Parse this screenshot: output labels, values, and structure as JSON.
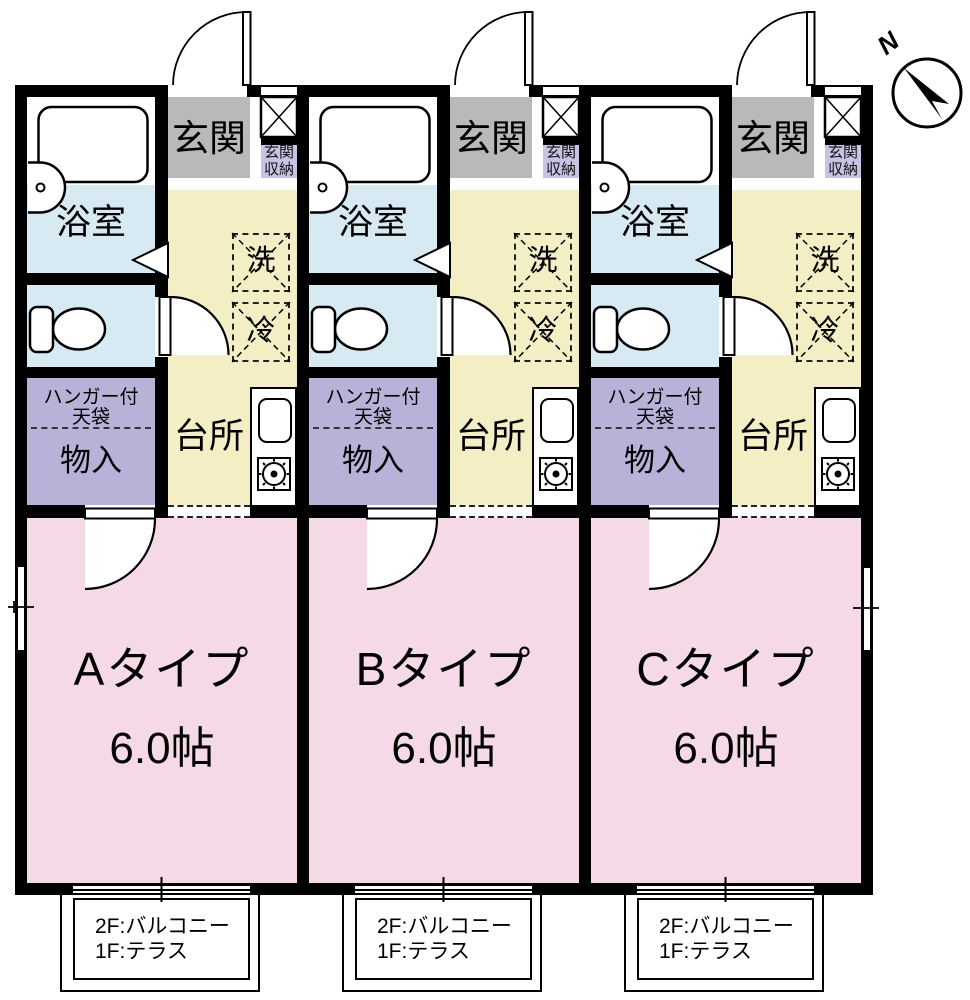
{
  "compass": {
    "label": "N"
  },
  "units": [
    {
      "id": "A",
      "type_label": "Aタイプ",
      "size_label": "6.0帖"
    },
    {
      "id": "B",
      "type_label": "Bタイプ",
      "size_label": "6.0帖"
    },
    {
      "id": "C",
      "type_label": "Cタイプ",
      "size_label": "6.0帖"
    }
  ],
  "room_labels": {
    "entrance": "玄関",
    "entrance_storage": "玄関\n収納",
    "bathroom": "浴室",
    "washer": "洗",
    "refrigerator": "冷",
    "kitchen": "台所",
    "closet_upper": "ハンガー付\n天袋",
    "closet": "物入"
  },
  "balcony_note": "2F:バルコニー\n1F:テラス",
  "colors": {
    "wall": "#000000",
    "entrance_floor": "#b9b9b9",
    "hall_kitchen_floor": "#f4eec5",
    "bath_toilet_floor": "#d7eaf4",
    "closet_floor": "#b6b2d8",
    "closet_label_bg": "#c7c3e4",
    "main_room_floor": "#f5d9e6"
  }
}
